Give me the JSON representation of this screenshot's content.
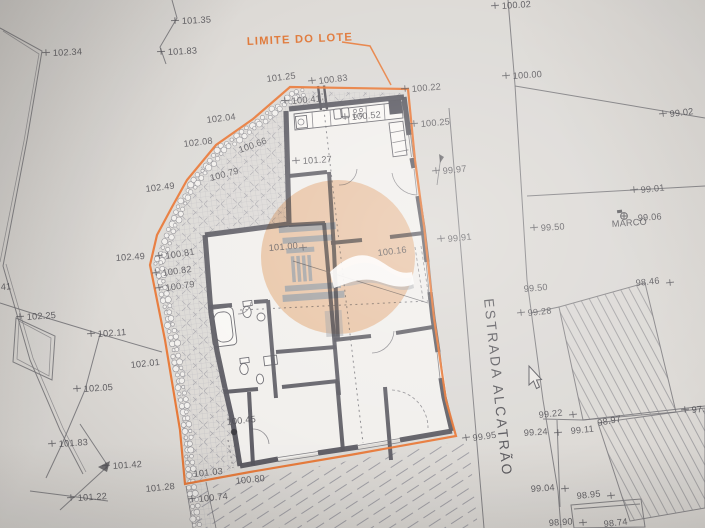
{
  "labels": {
    "lot_boundary": "LIMITE DO LOTE",
    "street": "ESTRADA ALCATRÃO",
    "benchmark": "MARCO",
    "edge_cut": "41"
  },
  "colors": {
    "boundary_orange": "#e06c26",
    "watermark_orange": "#f4c9a4",
    "watermark_gray": "#9aa0aa",
    "wall_gray": "#4e4e57",
    "paper": "#dcdad7"
  },
  "survey_points": [
    {
      "v": "100.02",
      "x": 502,
      "y": 9,
      "r": -4,
      "t": "l"
    },
    {
      "v": "100.00",
      "x": 513,
      "y": 79,
      "r": -4,
      "t": "l"
    },
    {
      "v": "99.02",
      "x": 670,
      "y": 117,
      "r": -7,
      "t": "l"
    },
    {
      "v": "99.01",
      "x": 641,
      "y": 193,
      "r": -6,
      "t": "l"
    },
    {
      "v": "99.06",
      "x": 638,
      "y": 221,
      "r": -4,
      "t": "n"
    },
    {
      "v": "MARCO",
      "x": 612,
      "y": 227,
      "r": -4,
      "t": "n",
      "s": 4.2
    },
    {
      "v": "99.50",
      "x": 541,
      "y": 231,
      "r": -4,
      "t": "l"
    },
    {
      "v": "99.50",
      "x": 524,
      "y": 292,
      "r": -5,
      "t": "n"
    },
    {
      "v": "99.28",
      "x": 528,
      "y": 316,
      "r": -6,
      "t": "l"
    },
    {
      "v": "98.46",
      "x": 636,
      "y": 286,
      "r": -6,
      "t": "r"
    },
    {
      "v": "97.7",
      "x": 692,
      "y": 413,
      "r": -6,
      "t": "l"
    },
    {
      "v": "99.22",
      "x": 539,
      "y": 418,
      "r": -6,
      "t": "r"
    },
    {
      "v": "99.24",
      "x": 524,
      "y": 436,
      "r": -4,
      "t": "r"
    },
    {
      "v": "99.11",
      "x": 571,
      "y": 434,
      "r": -6,
      "t": "n"
    },
    {
      "v": "98.97",
      "x": 598,
      "y": 426,
      "r": -11,
      "t": "n"
    },
    {
      "v": "99.04",
      "x": 531,
      "y": 492,
      "r": -4,
      "t": "r"
    },
    {
      "v": "98.95",
      "x": 577,
      "y": 499,
      "r": -6,
      "t": "r"
    },
    {
      "v": "98.90",
      "x": 549,
      "y": 526,
      "r": -4,
      "t": "r"
    },
    {
      "v": "98.74",
      "x": 604,
      "y": 527,
      "r": -6,
      "t": "n"
    },
    {
      "v": "99.95",
      "x": 473,
      "y": 441,
      "r": -8,
      "t": "l"
    },
    {
      "v": "99.97",
      "x": 443,
      "y": 174,
      "r": -6,
      "t": "l"
    },
    {
      "v": "99.91",
      "x": 448,
      "y": 242,
      "r": -6,
      "t": "l"
    },
    {
      "v": "100.22",
      "x": 412,
      "y": 92,
      "r": -5,
      "t": "l"
    },
    {
      "v": "100.25",
      "x": 421,
      "y": 127,
      "r": -5,
      "t": "l"
    },
    {
      "v": "101.25",
      "x": 267,
      "y": 82,
      "r": -7,
      "t": "n"
    },
    {
      "v": "100.83",
      "x": 319,
      "y": 84,
      "r": -7,
      "t": "l"
    },
    {
      "v": "100.41",
      "x": 292,
      "y": 104,
      "r": -5,
      "t": "l"
    },
    {
      "v": "100.52",
      "x": 352,
      "y": 120,
      "r": -5,
      "t": "l"
    },
    {
      "v": "101.27",
      "x": 303,
      "y": 164,
      "r": -4,
      "t": "l"
    },
    {
      "v": "101.35",
      "x": 182,
      "y": 24,
      "r": -3,
      "t": "l"
    },
    {
      "v": "101.83",
      "x": 168,
      "y": 55,
      "r": -3,
      "t": "l"
    },
    {
      "v": "102.34",
      "x": 53,
      "y": 56,
      "r": -3,
      "t": "l"
    },
    {
      "v": "102.04",
      "x": 207,
      "y": 123,
      "r": -7,
      "t": "n"
    },
    {
      "v": "102.08",
      "x": 184,
      "y": 147,
      "r": -7,
      "t": "n"
    },
    {
      "v": "102.49",
      "x": 146,
      "y": 192,
      "r": -7,
      "t": "n"
    },
    {
      "v": "100.66",
      "x": 240,
      "y": 153,
      "r": -20,
      "t": "n"
    },
    {
      "v": "100.79",
      "x": 211,
      "y": 181,
      "r": -15,
      "t": "n"
    },
    {
      "v": "102.49",
      "x": 116,
      "y": 261,
      "r": -4,
      "t": "n"
    },
    {
      "v": "100.81",
      "x": 166,
      "y": 259,
      "r": -9,
      "t": "l"
    },
    {
      "v": "100.82",
      "x": 163,
      "y": 276,
      "r": -8,
      "t": "l"
    },
    {
      "v": "100.79",
      "x": 166,
      "y": 291,
      "r": -8,
      "t": "l"
    },
    {
      "v": "101.00",
      "x": 269,
      "y": 251,
      "r": -5,
      "t": "r"
    },
    {
      "v": "100.16",
      "x": 378,
      "y": 256,
      "r": -7,
      "t": "n"
    },
    {
      "v": "102.25",
      "x": 27,
      "y": 320,
      "r": -4,
      "t": "l"
    },
    {
      "v": "102.11",
      "x": 98,
      "y": 337,
      "r": -4,
      "t": "l"
    },
    {
      "v": "102.01",
      "x": 131,
      "y": 368,
      "r": -6,
      "t": "n"
    },
    {
      "v": "102.05",
      "x": 84,
      "y": 392,
      "r": -4,
      "t": "l"
    },
    {
      "v": "101.83",
      "x": 59,
      "y": 447,
      "r": -4,
      "t": "l"
    },
    {
      "v": "101.42",
      "x": 113,
      "y": 469,
      "r": -4,
      "t": "l"
    },
    {
      "v": "101.22",
      "x": 78,
      "y": 501,
      "r": -4,
      "t": "l"
    },
    {
      "v": "101.28",
      "x": 146,
      "y": 492,
      "r": -6,
      "t": "n"
    },
    {
      "v": "100.74",
      "x": 199,
      "y": 502,
      "r": -6,
      "t": "l"
    },
    {
      "v": "101.03",
      "x": 194,
      "y": 477,
      "r": -6,
      "t": "n"
    },
    {
      "v": "100.80",
      "x": 236,
      "y": 484,
      "r": -6,
      "t": "n"
    },
    {
      "v": "100.45",
      "x": 227,
      "y": 425,
      "r": -6,
      "t": "n"
    },
    {
      "v": "41",
      "x": 1,
      "y": 290,
      "r": -4,
      "t": "n"
    }
  ]
}
